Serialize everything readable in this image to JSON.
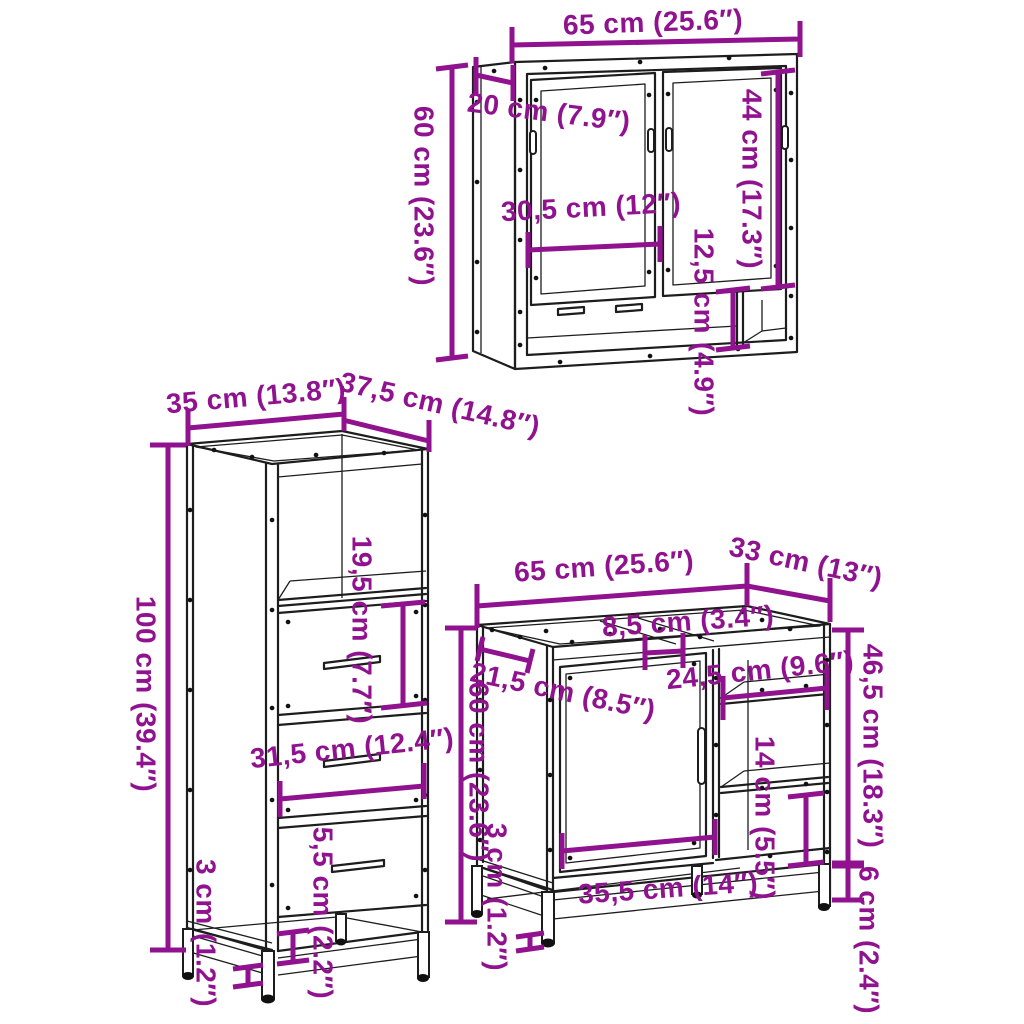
{
  "style": {
    "background": "#FFFFFF",
    "dimension_color": "#90128F",
    "line_color": "#1D1D1D"
  },
  "pieces": {
    "mirror_cabinet": {
      "dims": {
        "width": "65 cm (25.6″)",
        "height": "60 cm (23.6″)",
        "depth": "20 cm (7.9″)",
        "door_height": "44 cm (17.3″)",
        "inner_width": "30,5 cm (12″)",
        "shelf_height": "12,5 cm (4.9″)"
      }
    },
    "tall_cabinet": {
      "dims": {
        "width": "35 cm (13.8″)",
        "depth": "37,5 cm (14.8″)",
        "height": "100 cm (39.4″)",
        "drawer_height": "19,5 cm (7.7″)",
        "inner_width": "31,5 cm (12.4″)",
        "clearance": "5,5 cm (2.2″)",
        "leg_height": "3 cm (1.2″)"
      }
    },
    "sink_cabinet": {
      "dims": {
        "width": "65 cm (25.6″)",
        "depth": "33 cm (13″)",
        "rail_gap": "8,5 cm (3.4″)",
        "shelf_width": "24,5 cm (9.6″)",
        "side_depth": "21,5 cm (8.5″)",
        "height": "60 cm (23.6″)",
        "right_height": "46,5 cm (18.3″)",
        "shelf_spacing": "14 cm (5.5″)",
        "door_width": "35,5 cm (14″)",
        "base_height": "6 cm (2.4″)",
        "leg_height": "3 cm (1.2″)"
      }
    }
  }
}
